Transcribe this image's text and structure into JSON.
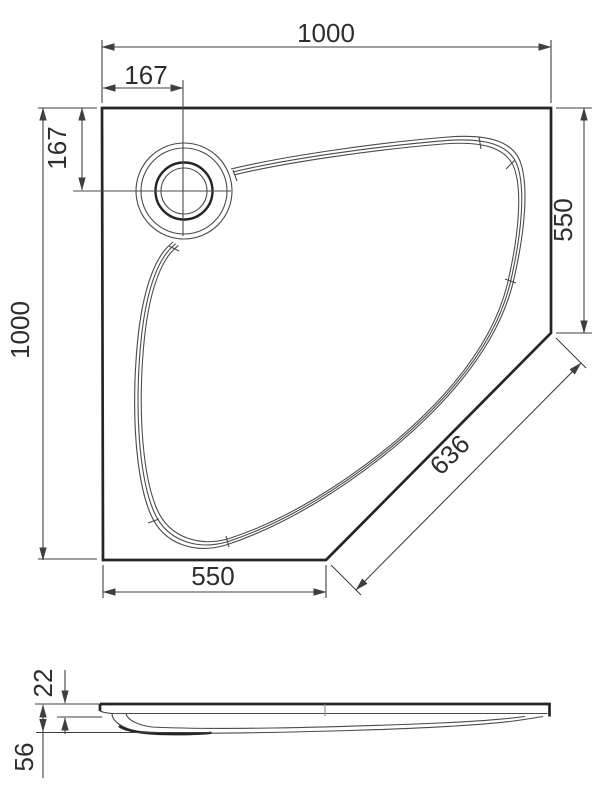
{
  "drawing": {
    "type": "shower-tray-technical-drawing",
    "views": [
      "plan",
      "side-profile"
    ],
    "colors": {
      "background": "#ffffff",
      "outline_bold": "#252525",
      "line_thin": "#4a4a4a",
      "dimension_line": "#3f3f3f",
      "text": "#2e2e2e"
    }
  },
  "dims": {
    "top_width": "1000",
    "drain_offset_top": "167",
    "drain_offset_left": "167",
    "left_height": "1000",
    "right_side": "550",
    "diagonal": "636",
    "bottom_side": "550",
    "profile_rim": "22",
    "profile_height": "56"
  }
}
